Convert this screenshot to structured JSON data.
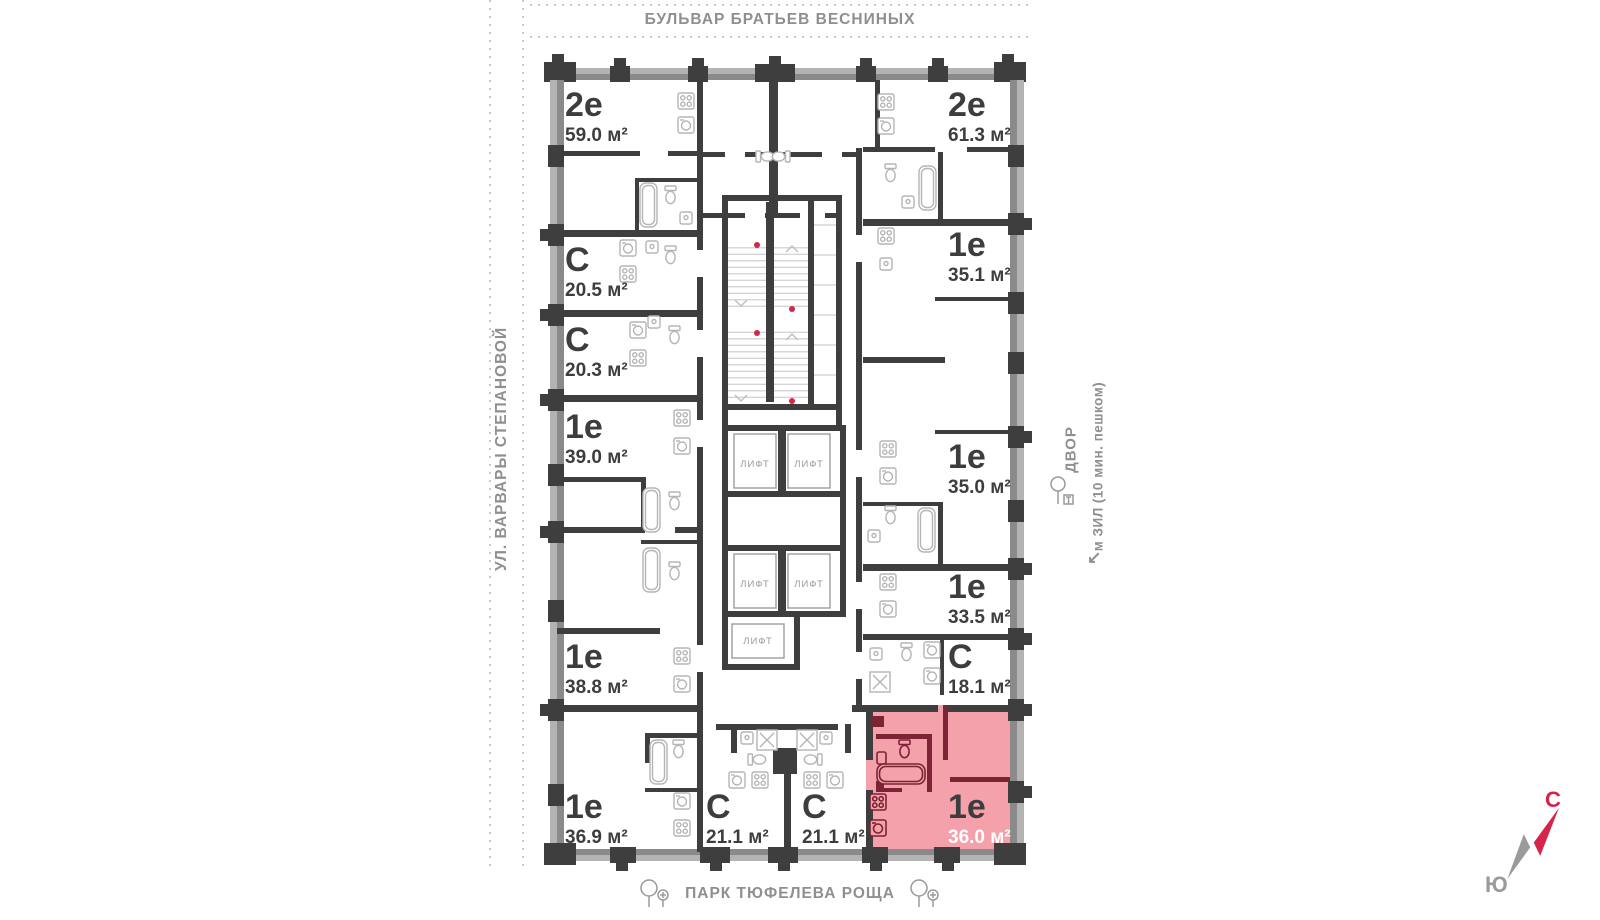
{
  "streets": {
    "top": "БУЛЬВАР БРАТЬЕВ ВЕСНИНЫХ",
    "left": "УЛ. ВАРВАРЫ СТЕПАНОВОЙ",
    "bottom": "ПАРК ТЮФЕЛЕВА РОЩА"
  },
  "landmarks": {
    "yard": "ДВОР",
    "metro": "м ЗИЛ (10 мин. пешком)",
    "metro_arrow": "↙"
  },
  "compass": {
    "north": "С",
    "south": "Ю"
  },
  "elevator_label": "ЛИФТ",
  "apartments": [
    {
      "type": "2е",
      "area": "59.0 м²",
      "highlighted": false
    },
    {
      "type": "С",
      "area": "20.5 м²",
      "highlighted": false
    },
    {
      "type": "С",
      "area": "20.3 м²",
      "highlighted": false
    },
    {
      "type": "1е",
      "area": "39.0 м²",
      "highlighted": false
    },
    {
      "type": "1е",
      "area": "38.8 м²",
      "highlighted": false
    },
    {
      "type": "1е",
      "area": "36.9 м²",
      "highlighted": false
    },
    {
      "type": "С",
      "area": "21.1 м²",
      "highlighted": false
    },
    {
      "type": "С",
      "area": "21.1 м²",
      "highlighted": false
    },
    {
      "type": "2е",
      "area": "61.3 м²",
      "highlighted": false
    },
    {
      "type": "1е",
      "area": "35.1 м²",
      "highlighted": false
    },
    {
      "type": "1е",
      "area": "35.0 м²",
      "highlighted": false
    },
    {
      "type": "1е",
      "area": "33.5 м²",
      "highlighted": false
    },
    {
      "type": "С",
      "area": "18.1 м²",
      "highlighted": false
    },
    {
      "type": "1е",
      "area": "36.0 м²",
      "highlighted": true
    }
  ],
  "colors": {
    "wall": "#3e3e3e",
    "facade_light": "#b3b3b3",
    "facade_mid": "#8a8a8a",
    "highlight_fill": "#f4a1ab",
    "highlight_wall": "#7c2334",
    "accent_red": "#d6244a",
    "fixture": "#b5b5b5",
    "label_dark": "#3d3d3d",
    "street_gray": "#8f8f8f"
  }
}
